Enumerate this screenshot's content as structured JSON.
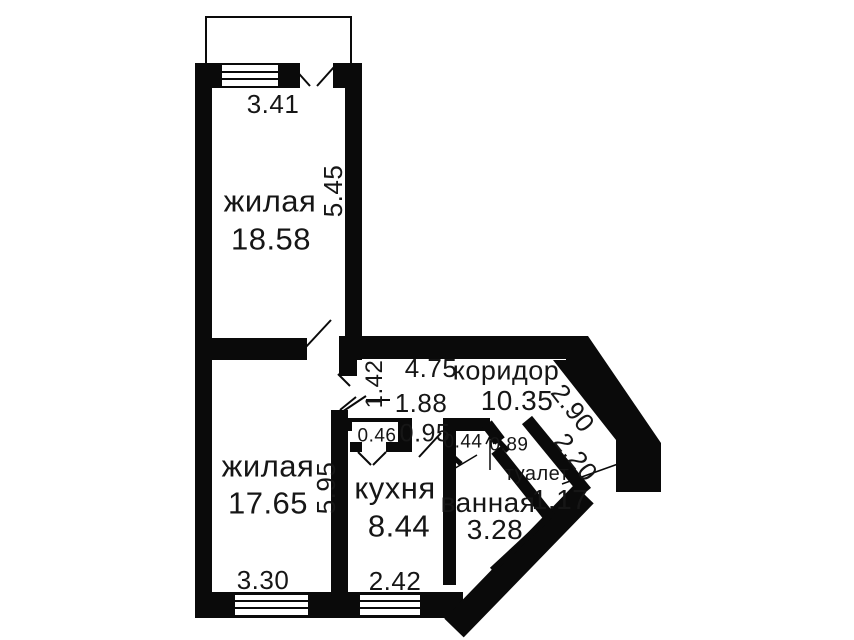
{
  "colors": {
    "wall": "#0a0a0a",
    "text": "#161616",
    "bg": "#ffffff"
  },
  "rooms": {
    "living1": {
      "name": "жилая",
      "area": "18.58"
    },
    "living2": {
      "name": "жилая",
      "area": "17.65"
    },
    "kitchen": {
      "name": "кухня",
      "area": "8.44"
    },
    "bathroom": {
      "name": "ванная",
      "area": "3.28"
    },
    "toilet": {
      "name": "туалет",
      "area": "1.17"
    },
    "corridor": {
      "name": "коридор",
      "area": "10.35"
    }
  },
  "dimensions": {
    "living1_width": "3.41",
    "living1_depth": "5.45",
    "living2_width": "3.30",
    "living2_depth": "5.95",
    "kitchen_width": "2.42",
    "corridor_length": "4.75",
    "corridor_width": "1.42",
    "kitchen_offset": "1.88",
    "niche_depth": "0.46",
    "kitchen_door": "0.95",
    "bath_door": "0.44",
    "toilet_door": "0.89",
    "diagonal_outer": "2.90",
    "diagonal_inner": "2.20"
  }
}
